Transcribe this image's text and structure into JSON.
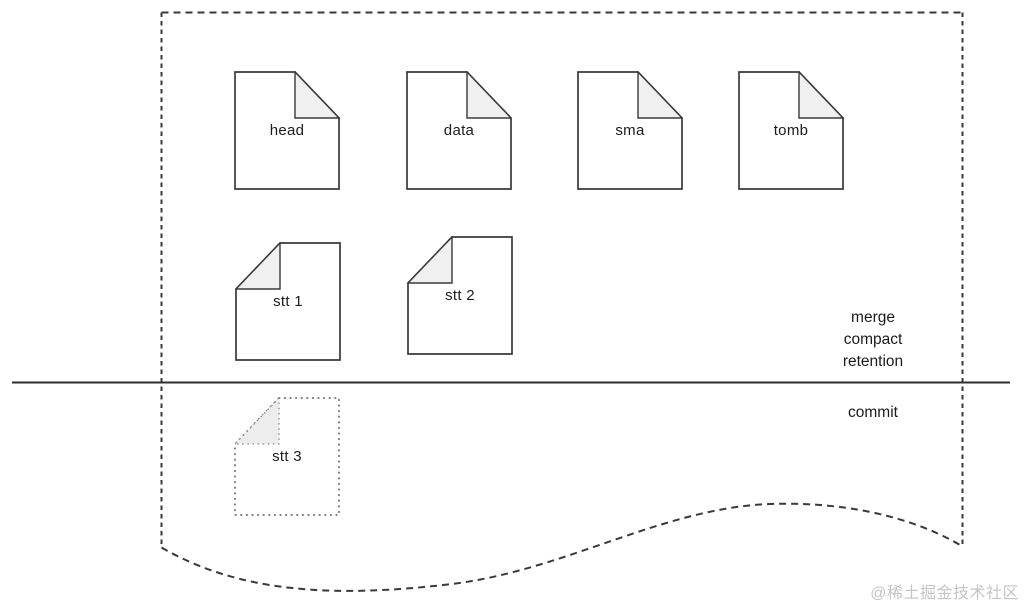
{
  "colors": {
    "stroke": "#3a3a3a",
    "fold_fill": "#f0f0f0",
    "text": "#1c1c1c",
    "watermark": "#c5c5c5",
    "background": "#ffffff"
  },
  "files": {
    "row1": [
      {
        "label": "head"
      },
      {
        "label": "data"
      },
      {
        "label": "sma"
      },
      {
        "label": "tomb"
      }
    ],
    "row2": [
      {
        "label": "stt 1"
      },
      {
        "label": "stt 2"
      }
    ],
    "below_line": [
      {
        "label": "stt 3"
      }
    ]
  },
  "annotations": {
    "above_line": [
      "merge",
      "compact",
      "retention"
    ],
    "below_line_label": "commit"
  },
  "watermark": "@稀土掘金技术社区"
}
